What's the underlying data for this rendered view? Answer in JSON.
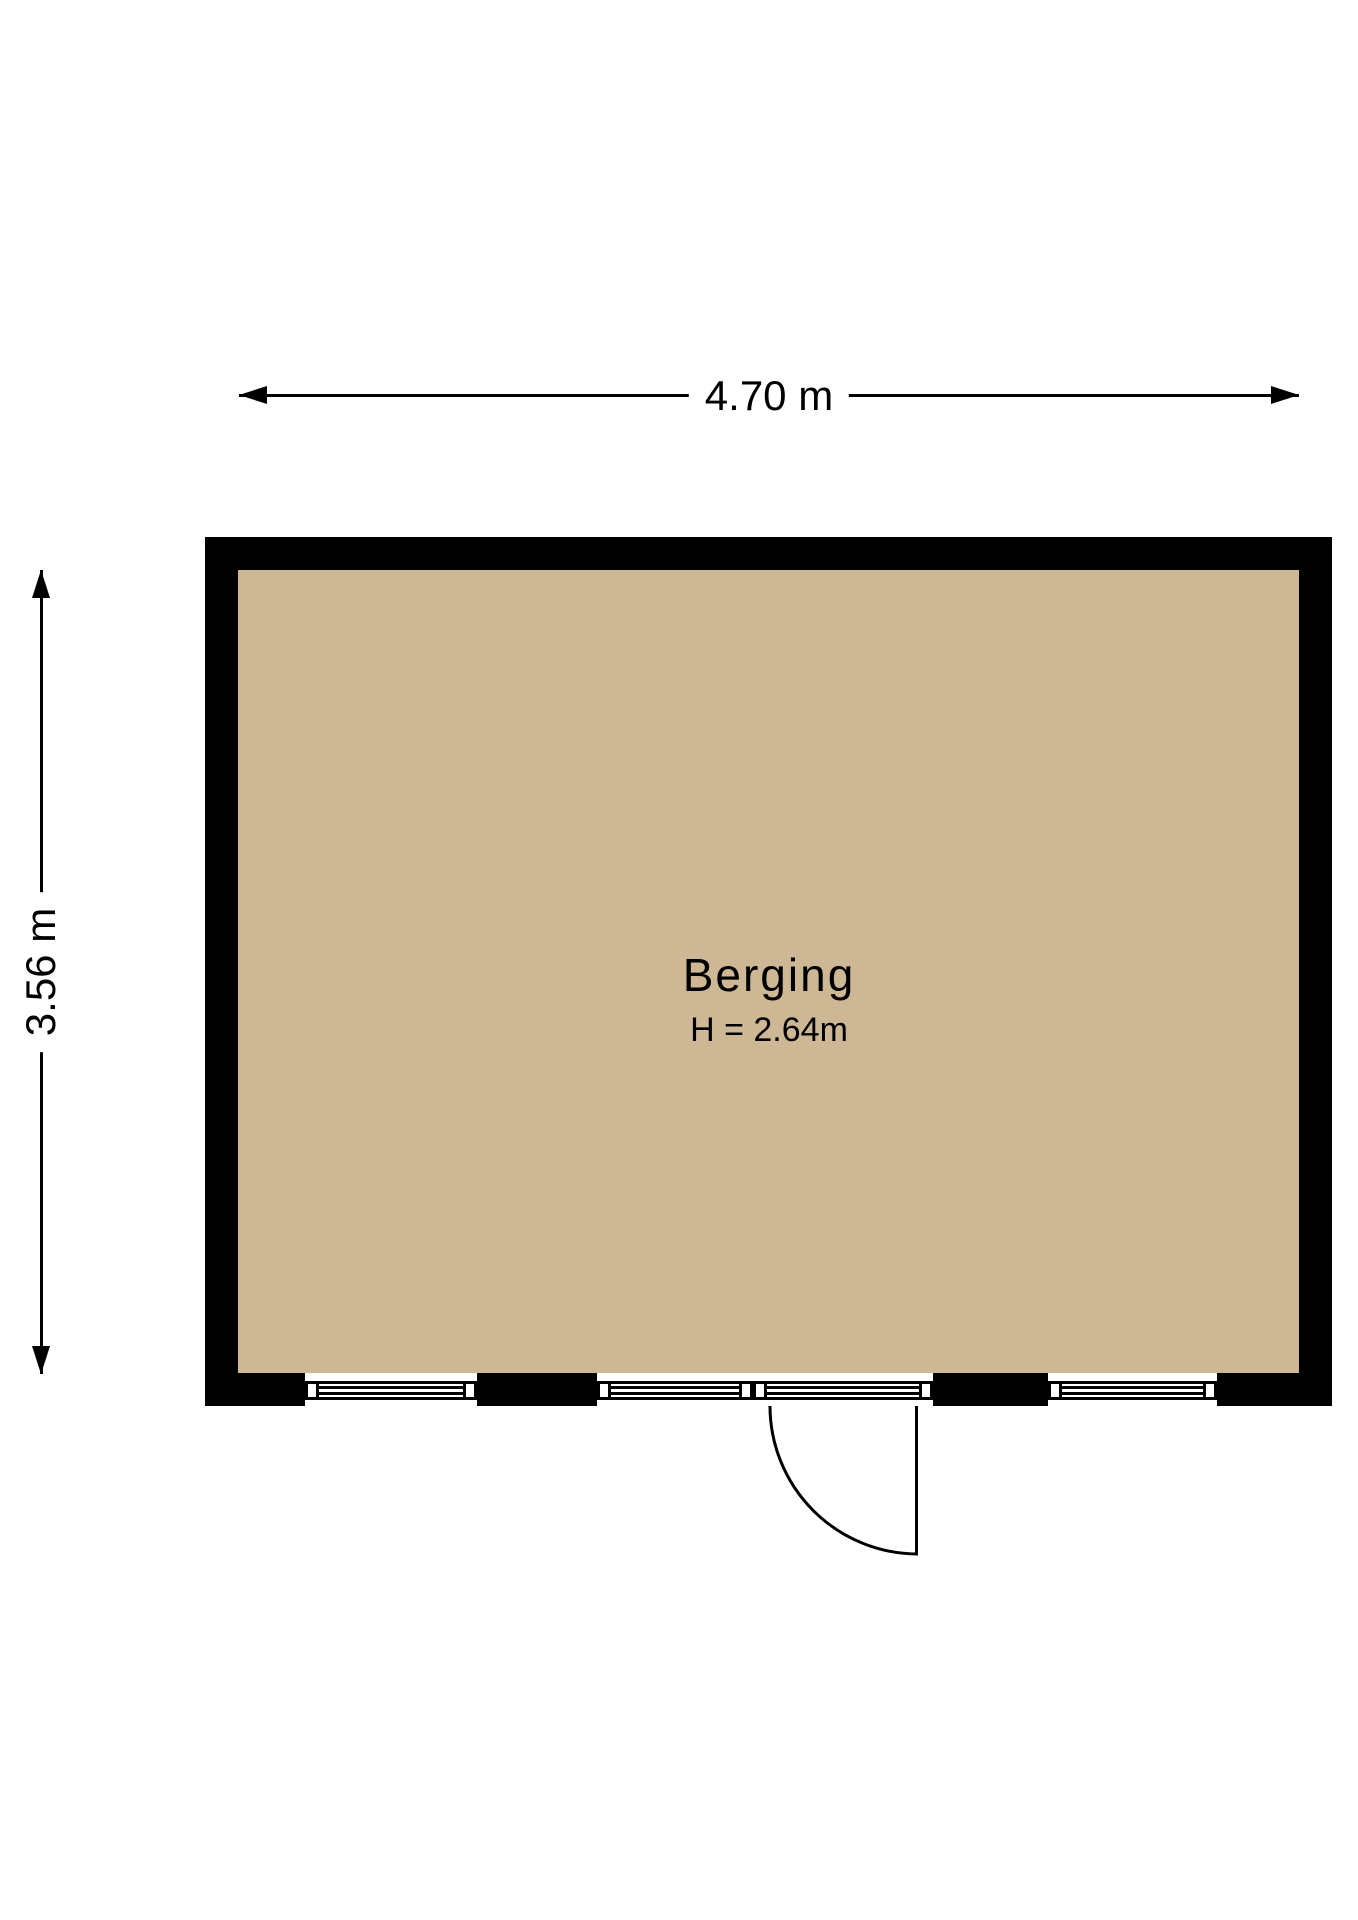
{
  "floorplan": {
    "room": {
      "name": "Berging",
      "ceiling_height_label": "H = 2.64m"
    },
    "dimensions": {
      "width_label": "4.70 m",
      "height_label": "3.56 m"
    },
    "colors": {
      "floor": "#cdb794",
      "wall": "#000000",
      "background": "#ffffff",
      "line": "#000000"
    }
  }
}
